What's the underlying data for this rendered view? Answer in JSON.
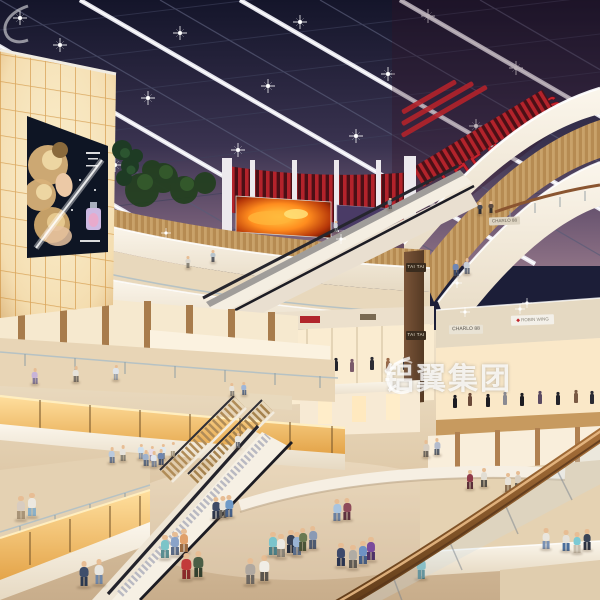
{
  "meta": {
    "description": "Photorealistic architectural rendering of a multi-level shopping mall atrium at dusk: dark glazed skylight with lit beams, red THEATRES sign, glowing billboard wall, curved cream balconies, escalators and shoppers",
    "watermark": "铝翼集团"
  },
  "signs": {
    "theatres": "THEATRES",
    "tai_tai_upper": "TAI TAI",
    "tai_tai_lower": "TAI TAI",
    "charlo_upper": "CHARLO 88",
    "charlo_lower": "CHARLO 88",
    "robin_wing": "ROBIN WING",
    "robin_diamond": "◆"
  },
  "colors": {
    "sky_top": "#14152a",
    "sky_horizon": "#8d7185",
    "beam_white": "#ffffff",
    "theatres_red": "#c8232e",
    "slat_red": "#b3232b",
    "screen_orange": "#ff8c1e",
    "wood_fascia": "#c49a5e",
    "cream_band": "#f4ede1",
    "amber_glow": "#f2b969",
    "floor_beige": "#dcc6a6",
    "handrail_wood": "#8a5a2b",
    "billboard_bg": "#0e1524"
  },
  "people": [
    [
      188,
      268,
      12,
      "#d9d5cd",
      "#8a8478"
    ],
    [
      213,
      262,
      12,
      "#b8c4cc",
      "#5a5e66"
    ],
    [
      480,
      214,
      12,
      "#434754",
      "#2c2c34"
    ],
    [
      491,
      213,
      12,
      "#5a4a42",
      "#33302e"
    ],
    [
      336,
      232,
      11,
      "#d0d5db",
      "#6b6f77"
    ],
    [
      390,
      209,
      11,
      "#8a93a3",
      "#4a4e58"
    ],
    [
      456,
      276,
      16,
      "#6f86b4",
      "#3e4a66"
    ],
    [
      467,
      274,
      16,
      "#c9cfd8",
      "#6b7282"
    ],
    [
      35,
      384,
      16,
      "#c8b4d8",
      "#857a9a"
    ],
    [
      76,
      382,
      16,
      "#e6e2da",
      "#7a736a"
    ],
    [
      116,
      380,
      15,
      "#dfe4ea",
      "#9ba2ac"
    ],
    [
      232,
      396,
      13,
      "#e8e4dc",
      "#8a857c"
    ],
    [
      244,
      395,
      13,
      "#9fb6d8",
      "#5d6e8a"
    ],
    [
      426,
      457,
      17,
      "#d8cfc2",
      "#6e675e"
    ],
    [
      437,
      455,
      17,
      "#b4bccd",
      "#59616e"
    ],
    [
      470,
      489,
      19,
      "#8e3a4a",
      "#5a2e38"
    ],
    [
      484,
      487,
      19,
      "#e2ded4",
      "#54504a"
    ],
    [
      508,
      492,
      19,
      "#e8e2d8",
      "#8a6f52"
    ],
    [
      518,
      490,
      19,
      "#d9cfc0",
      "#6b6458"
    ],
    [
      546,
      549,
      21,
      "#eae6de",
      "#7a92b4"
    ],
    [
      566,
      551,
      21,
      "#e6e2da",
      "#4a6e9c"
    ],
    [
      577,
      553,
      21,
      "#7ccad4",
      "#c9bfae"
    ],
    [
      587,
      550,
      21,
      "#3a4456",
      "#2c3240"
    ],
    [
      141,
      459,
      15,
      "#cfe0ee",
      "#8a97a8"
    ],
    [
      152,
      461,
      15,
      "#e8dce8",
      "#9a8eaa"
    ],
    [
      163,
      459,
      15,
      "#dde8f0",
      "#7a879a"
    ],
    [
      173,
      457,
      15,
      "#f0e8da",
      "#a89a82"
    ],
    [
      112,
      463,
      16,
      "#b9c9dd",
      "#6a7890"
    ],
    [
      123,
      461,
      16,
      "#e6e3dc",
      "#8a8578"
    ],
    [
      146,
      466,
      16,
      "#9fb2cc",
      "#5c6a80"
    ],
    [
      154,
      467,
      16,
      "#dfe6ee",
      "#7c8698"
    ],
    [
      161,
      465,
      16,
      "#6f86b0",
      "#44516b"
    ],
    [
      238,
      448,
      15,
      "#e9e7e1",
      "#6a6e78"
    ],
    [
      21,
      520,
      24,
      "#d8ccc0",
      "#a89478"
    ],
    [
      32,
      517,
      24,
      "#ece8e0",
      "#8ab0c8"
    ],
    [
      84,
      587,
      26,
      "#3e4e6b",
      "#2a3850"
    ],
    [
      99,
      585,
      26,
      "#e8e6e0",
      "#6f87a8"
    ],
    [
      165,
      559,
      24,
      "#7cc4c8",
      "#5a8e92"
    ],
    [
      175,
      556,
      24,
      "#8aa3c8",
      "#5a6b88"
    ],
    [
      184,
      553,
      24,
      "#e0a06a",
      "#9a6b42"
    ],
    [
      216,
      519,
      22,
      "#3e4a66",
      "#2c3448"
    ],
    [
      223,
      518,
      22,
      "#e8e4dc",
      "#6b665e"
    ],
    [
      229,
      517,
      22,
      "#6f9ac8",
      "#44608a"
    ],
    [
      186,
      580,
      27,
      "#c23a3a",
      "#8a2a2a"
    ],
    [
      198,
      578,
      27,
      "#4a5e46",
      "#33402f"
    ],
    [
      250,
      585,
      27,
      "#b0a8a0",
      "#6e6862"
    ],
    [
      264,
      582,
      27,
      "#f0ede6",
      "#5a554e"
    ],
    [
      273,
      556,
      24,
      "#7ac4cc",
      "#4a7e86"
    ],
    [
      281,
      558,
      24,
      "#ece9e2",
      "#8a8478"
    ],
    [
      291,
      554,
      24,
      "#3a4458",
      "#262e3e"
    ],
    [
      297,
      556,
      24,
      "#9ab4d4",
      "#5a6e8c"
    ],
    [
      303,
      551,
      23,
      "#6b7a52",
      "#4a5438"
    ],
    [
      313,
      549,
      23,
      "#8a9ab4",
      "#4e5a70"
    ],
    [
      337,
      521,
      22,
      "#a8c4e0",
      "#6b80a0"
    ],
    [
      347,
      520,
      22,
      "#8e4a5a",
      "#5e3240"
    ],
    [
      341,
      567,
      24,
      "#3e4a6b",
      "#2a3450"
    ],
    [
      353,
      569,
      24,
      "#b0aca4",
      "#5f5b54"
    ],
    [
      363,
      565,
      24,
      "#6f93c4",
      "#45608a"
    ],
    [
      371,
      561,
      24,
      "#7a4a9c",
      "#4e3268"
    ],
    [
      421,
      579,
      25,
      "#6fb4bc",
      "#3e7a84"
    ]
  ]
}
